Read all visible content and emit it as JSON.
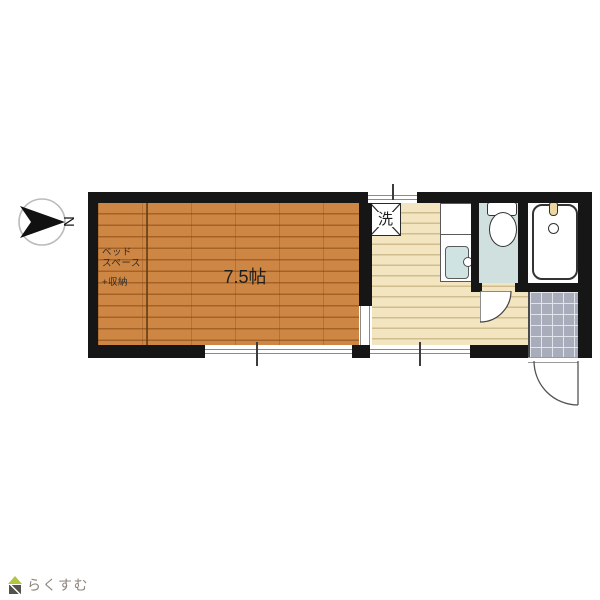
{
  "plan": {
    "main_room": {
      "area_label": "7.5帖"
    },
    "bed_space": {
      "line1": "ベッド",
      "line2": "スペース",
      "line3": "+収納"
    },
    "washer_label": "洗",
    "compass_label": "N"
  },
  "footer": {
    "logo_text": "らくすむ"
  },
  "colors": {
    "wall": "#161616",
    "wood_floor": "#cd8644",
    "kitchen_floor": "#f2e5c0",
    "toilet_floor": "#cfe0de",
    "entrance_tile": "#a9adbb",
    "logo_green": "#b3c43f",
    "logo_gray": "#8e857c"
  }
}
